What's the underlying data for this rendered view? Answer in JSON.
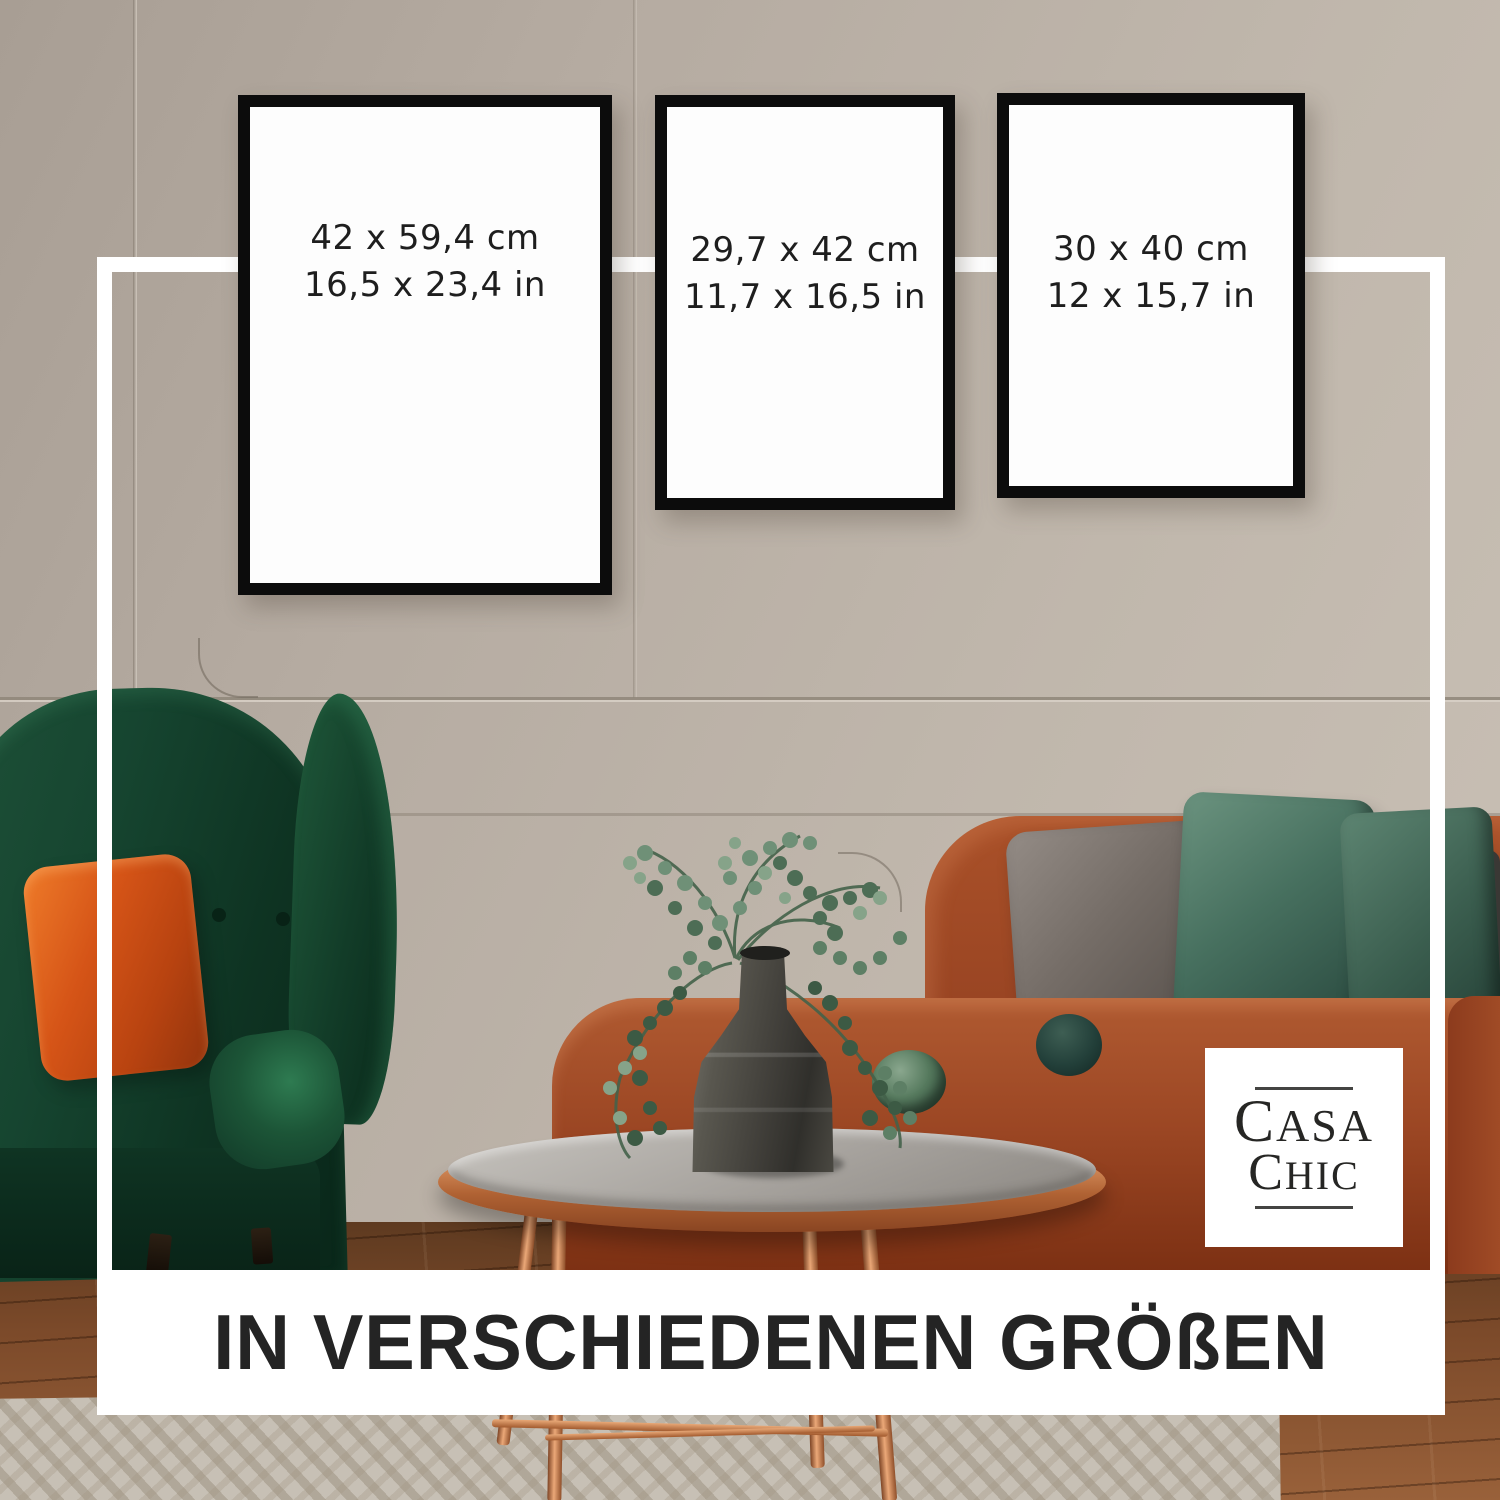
{
  "headline": "IN VERSCHIEDENEN GRÖßEN",
  "frames": [
    {
      "cm": "42 x 59,4 cm",
      "inch": "16,5 x 23,4 in"
    },
    {
      "cm": "29,7 x 42 cm",
      "inch": "11,7 x 16,5 in"
    },
    {
      "cm": "30 x 40 cm",
      "inch": "12 x 15,7 in"
    }
  ],
  "logo": {
    "casa": "CASA",
    "chic": "CHIC"
  },
  "colors": {
    "overlay_white": "#ffffff",
    "frame_black": "#0c0c0c",
    "text_dark": "#1e1e1e",
    "wall_taupe": "#b9b0a6",
    "chair_green": "#14402b",
    "cushion_orange": "#c8491a",
    "sofa_terracotta": "#9c4724",
    "table_copper": "#cf8757"
  }
}
